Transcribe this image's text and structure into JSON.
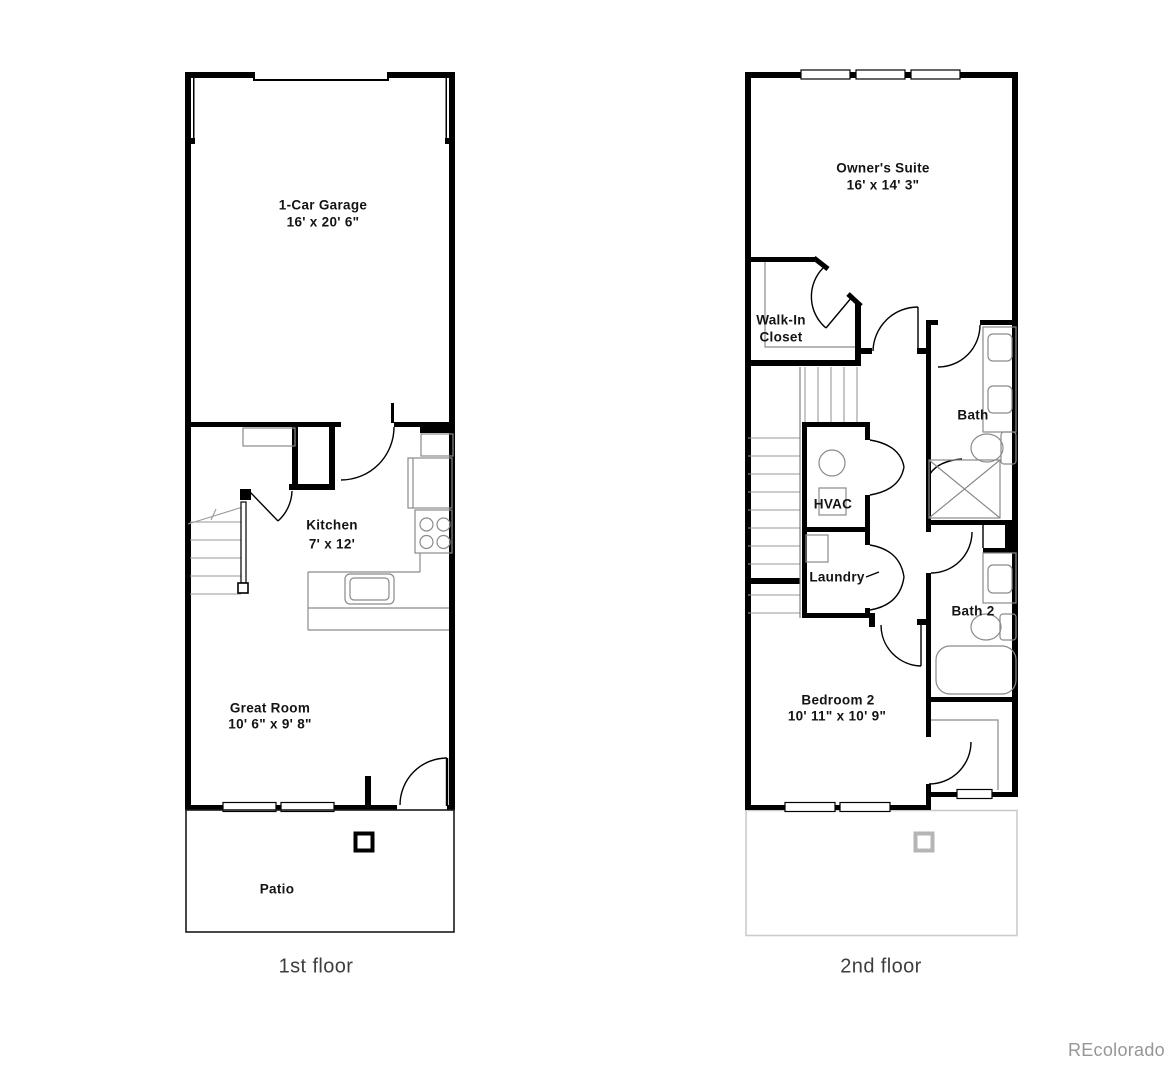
{
  "floor1": {
    "caption": "1st floor",
    "garage_name": "1-Car Garage",
    "garage_dims": "16' x 20' 6\"",
    "kitchen_name": "Kitchen",
    "kitchen_dims": "7' x 12'",
    "great_room_name": "Great Room",
    "great_room_dims": "10' 6\" x 9' 8\"",
    "patio_name": "Patio"
  },
  "floor2": {
    "caption": "2nd floor",
    "owners_suite_name": "Owner's Suite",
    "owners_suite_dims": "16' x 14' 3\"",
    "walk_in_closet_line1": "Walk-In",
    "walk_in_closet_line2": "Closet",
    "bath_name": "Bath",
    "hvac_name": "HVAC",
    "laundry_name": "Laundry",
    "bath2_name": "Bath 2",
    "bedroom2_name": "Bedroom 2",
    "bedroom2_dims": "10' 11\" x 10' 9\""
  },
  "watermark": "REcolorado",
  "colors": {
    "background": "#ffffff",
    "wall": "#000000",
    "door_line": "#000000",
    "fixture": "#8a8a8a",
    "stair_tread": "#9a9a9a",
    "ghost_patio": "#cbcbcb",
    "ghost_post": "#b5b5b5",
    "room_label": "#141414",
    "floor_caption": "#3e3e3e",
    "watermark": "#969696"
  }
}
